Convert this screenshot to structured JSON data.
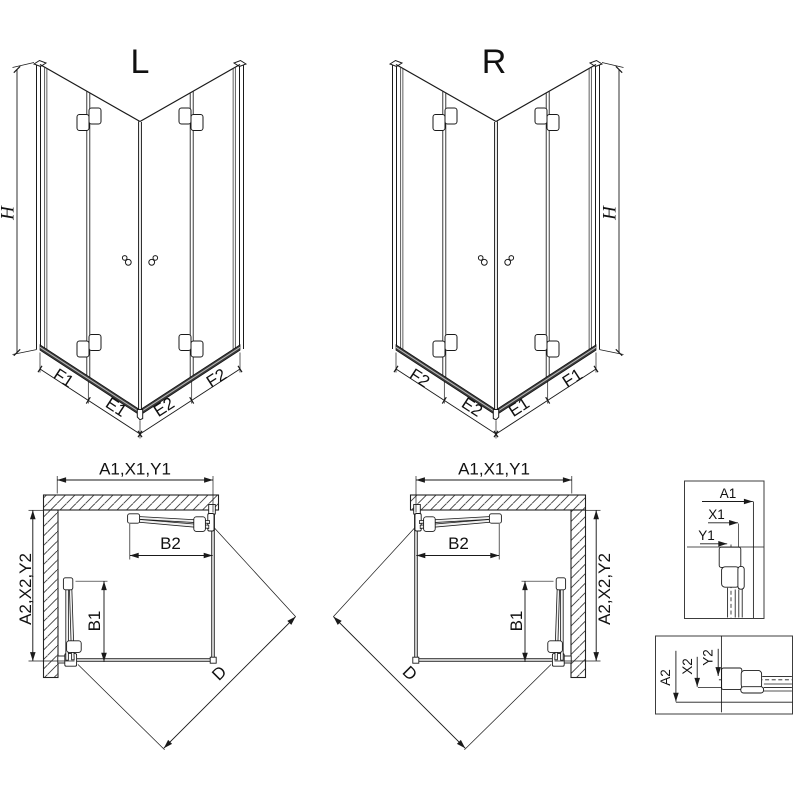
{
  "iso_left": {
    "label": "L",
    "height_dim": "H",
    "width_dims": [
      "F1",
      "E1",
      "E2",
      "F2"
    ]
  },
  "iso_right": {
    "label": "R",
    "height_dim": "H",
    "width_dims": [
      "F2",
      "E2",
      "E1",
      "F1"
    ]
  },
  "plan_left": {
    "width_dim": "A1,X1,Y1",
    "depth_dim": "A2,X2,Y2",
    "top_door_dim": "B2",
    "side_door_dim": "B1",
    "diagonal_dim": "D"
  },
  "plan_right": {
    "width_dim": "A1,X1,Y1",
    "depth_dim": "A2,X2,Y2",
    "top_door_dim": "B2",
    "side_door_dim": "B1",
    "diagonal_dim": "D"
  },
  "profile_detail_top": {
    "dims": [
      "A1",
      "X1",
      "Y1"
    ]
  },
  "profile_detail_bottom": {
    "dims": [
      "A2",
      "X2",
      "Y2"
    ]
  },
  "colors": {
    "line": "#1a1a1a",
    "glass_edge_bar": "#c6c6c6",
    "threshold": "#3a3a3a",
    "background": "#ffffff"
  }
}
